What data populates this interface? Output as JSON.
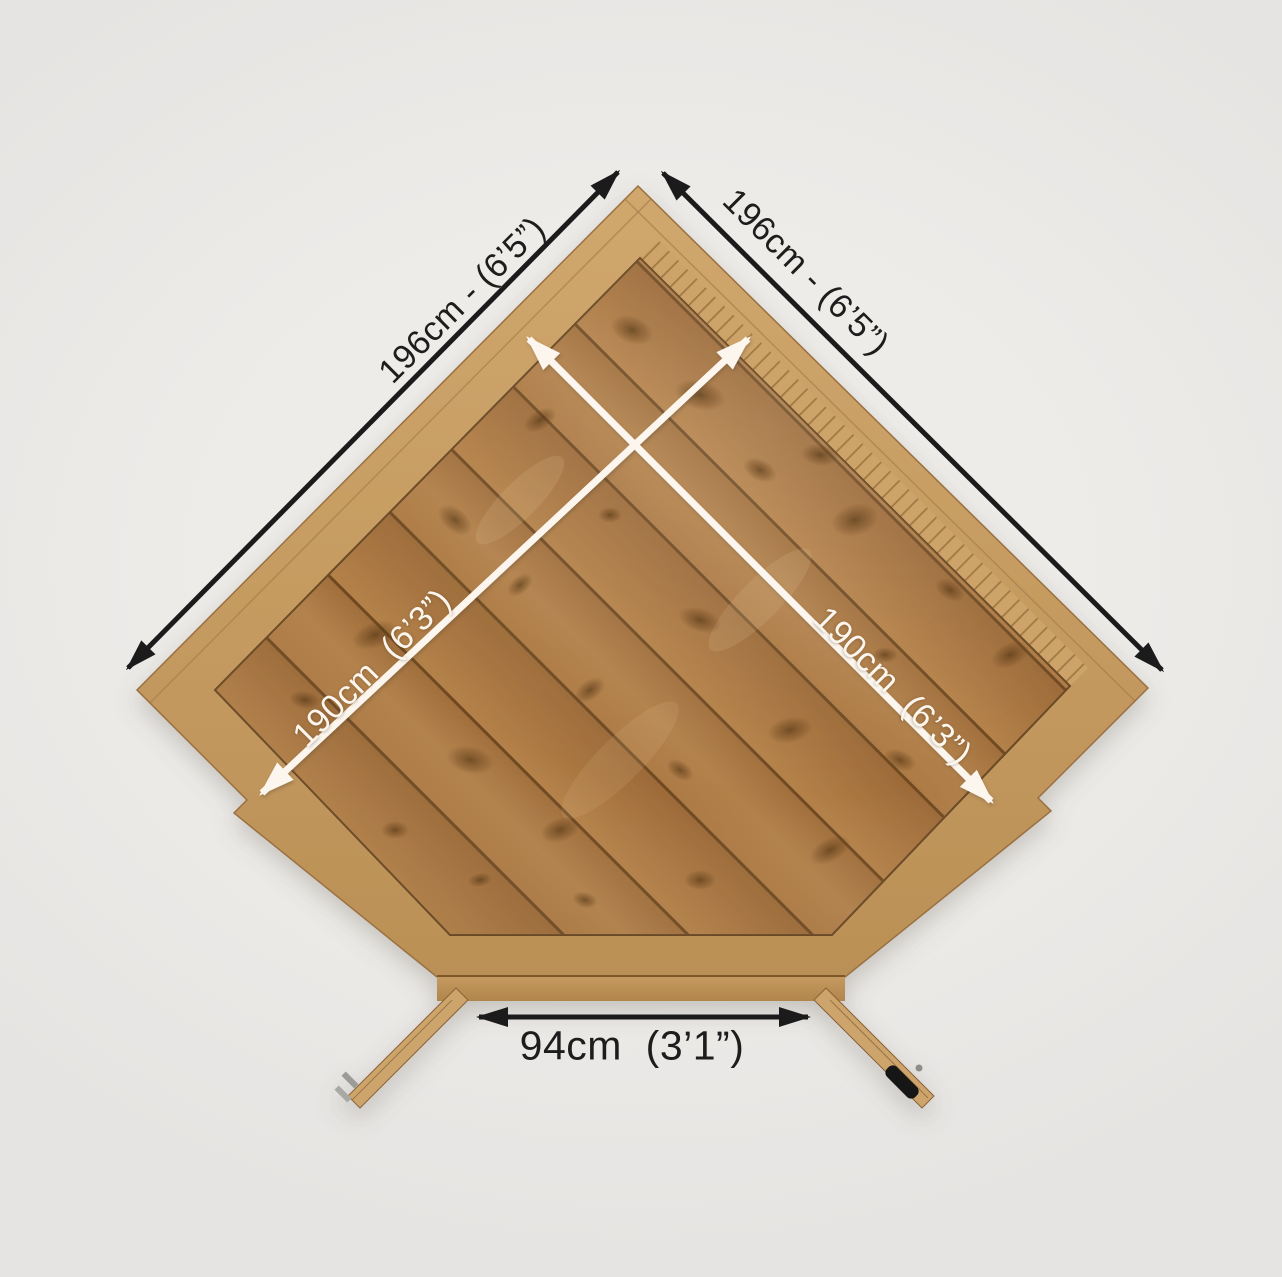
{
  "dimensions": {
    "wall_left": "196cm - (6’5”)",
    "wall_right": "196cm - (6’5”)",
    "depth_left": "190cm  (6’3”)",
    "depth_right": "190cm  (6’3”)",
    "door_width": "94cm  (3’1”)"
  },
  "colors": {
    "background": "#efedeb",
    "floor_wood": "#a87540",
    "floor_seam": "#6f4a22",
    "trim_wood": "#c89e63",
    "dimension_black": "#1b1b1b",
    "dimension_white": "#fcf6ee",
    "door_handle": "#141414"
  }
}
